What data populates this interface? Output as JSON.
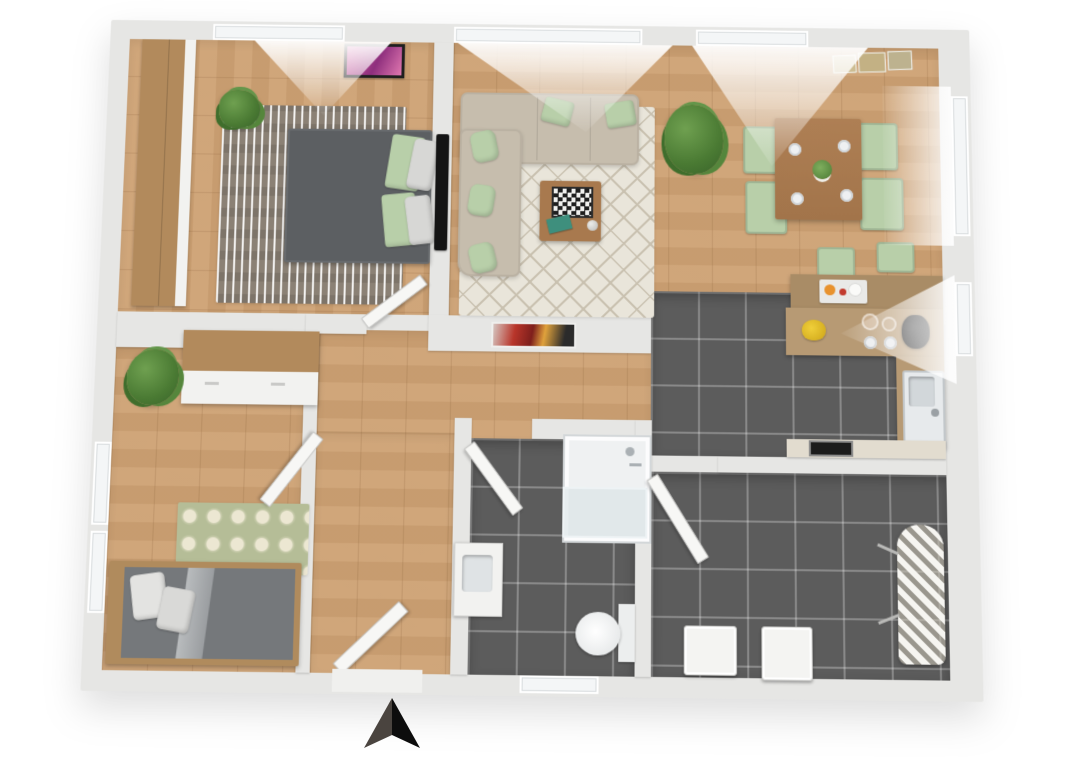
{
  "scene": {
    "type": "3d-floor-plan-top-down-render",
    "visible_text": "none",
    "compass": {
      "symbol": "north-arrow",
      "direction": "up",
      "position": "bottom-center"
    },
    "palette": {
      "background": "#ffffff",
      "wall": "#e6e6e4",
      "glass": "#f4f6f7",
      "door_white": "#f7f7f5",
      "wood_floor": "#cda173",
      "dark_tile": "#5c5c5c",
      "sofa": "#c6bdad",
      "mint": "#b8cfa9",
      "bed1_gray": "#5c5f62",
      "bed2_gray": "#75787b",
      "rug_living": "#e9e5da",
      "rug_living_line": "#c9c1b0",
      "rug_bed1": "#8b8175",
      "rug_bed2": "#b5bd97",
      "counter_wood": "#b79a74",
      "bar_wood": "#a98c66",
      "table_wood": "#a8794e",
      "art_pink": "#c2439a",
      "art_red": "#b33226",
      "plant_green": "#4a7a33",
      "oven_black": "#1c1c1c",
      "arrow_dark": "#4a443f",
      "arrow_black": "#0d0d0d"
    },
    "rooms": [
      {
        "name": "bedroom-1",
        "location": "top-left",
        "floor": "wood",
        "furniture": [
          "wardrobe",
          "double-bed-gray",
          "green-pillows",
          "gray-pillows",
          "striped-rug",
          "potted-plant",
          "pink-wall-art",
          "wall-tv"
        ]
      },
      {
        "name": "living-room",
        "location": "top-center",
        "floor": "wood",
        "furniture": [
          "corner-sofa-beige",
          "mint-cushions",
          "diamond-pattern-rug",
          "coffee-table",
          "chessboard",
          "teal-book",
          "decor-ball",
          "red-abstract-wall-art"
        ]
      },
      {
        "name": "dining-area",
        "location": "top-right",
        "floor": "wood",
        "furniture": [
          "wood-dining-table",
          "four-mint-chairs",
          "four-plates",
          "centerpiece-plant",
          "large-potted-plant",
          "three-wall-prints"
        ]
      },
      {
        "name": "kitchen",
        "location": "right",
        "floor": "dark-tile",
        "furniture": [
          "l-shaped-counter",
          "bar-counter",
          "two-bar-chairs",
          "breakfast-tray",
          "sink",
          "faucet",
          "coffee-machine",
          "jars",
          "fruit-basket-yellow",
          "oven"
        ]
      },
      {
        "name": "hallway",
        "location": "center",
        "floor": "wood",
        "furniture": [
          "entrance-door-open"
        ]
      },
      {
        "name": "bedroom-2",
        "location": "bottom-left",
        "floor": "wood",
        "furniture": [
          "single-bed-gray",
          "white-pillows",
          "ogee-pattern-rug",
          "dresser-sideboard",
          "potted-plant",
          "interior-door-open",
          "windows"
        ]
      },
      {
        "name": "bathroom",
        "location": "bottom-center",
        "floor": "dark-tile",
        "furniture": [
          "shower-enclosure",
          "toilet",
          "vanity-sink",
          "interior-door-open",
          "window"
        ]
      },
      {
        "name": "utility-room",
        "location": "bottom-right",
        "floor": "dark-tile",
        "furniture": [
          "washing-machine",
          "second-appliance",
          "ironing-board",
          "interior-door-open"
        ]
      }
    ]
  }
}
